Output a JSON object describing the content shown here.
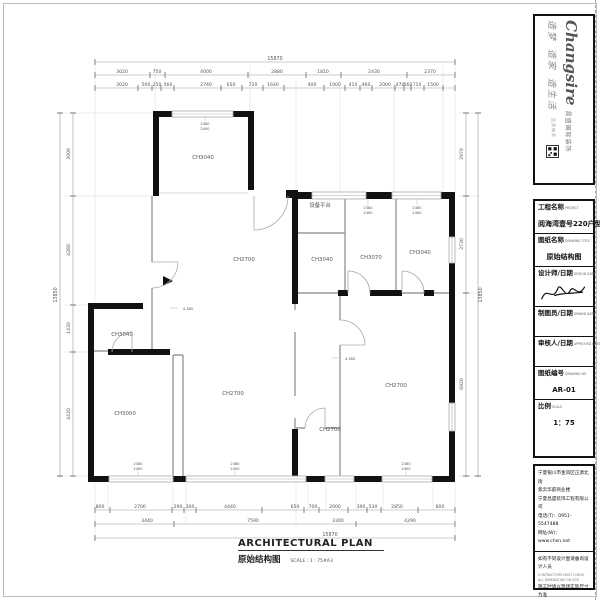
{
  "logo": {
    "brand_en": "Changsire",
    "brand_cn": "昌盛国际装饰",
    "slogan": [
      "造梦",
      "造家",
      "造生活"
    ],
    "tagline": "品质饰家"
  },
  "titleblock": {
    "project_label": "工程名称",
    "project_label_en": "PROJECT",
    "project_value": "阅海湾壹号220户型图",
    "drawing_label": "图纸名称",
    "drawing_label_en": "DRAWING TITLE",
    "drawing_value": "原始结构图",
    "designer_label": "设计师/日期",
    "designer_label_en": "DESIGN DATE",
    "drafter_label": "制图员/日期",
    "drafter_label_en": "DRAWN DATE",
    "auditor_label": "审核人/日期",
    "auditor_label_en": "APPROVED DATE",
    "number_label": "图纸编号",
    "number_label_en": "DRAWING NO",
    "number_value": "AR-01",
    "scale_label": "比例",
    "scale_label_en": "SCALE",
    "scale_value": "1：75"
  },
  "company": {
    "address1": "宁夏银川市金凤区正源北街",
    "address2": "紫云华庭商业楼",
    "name": "宁夏昌盛装饰工程有限公司",
    "phone": "电话(T)：0951-5547488",
    "website": "网址(W)：www.chsn.net",
    "note1": "如有不同设计图请垂询设计人员",
    "note1_en": "CONTRACTORS MUST CHECK ALL DIMENSIONS ON SITE",
    "note2": "施工时请以现场实际尺寸为准",
    "note2_en": "THIS DRAWING IS COPYRIGHT"
  },
  "footer": {
    "title_en": "ARCHITECTURAL PLAN",
    "title_cn": "原始结构图",
    "scale_note": "SCALE : 1 : 75#A3"
  },
  "plan": {
    "overall_top": "15870",
    "overall_bottom": "15870",
    "overall_left": "13850",
    "overall_right": "13850",
    "top_row1": [
      "3020",
      "750",
      "4000",
      "2880",
      "1810",
      "2430",
      "2370"
    ],
    "top_row2": [
      "3020",
      "500",
      "250",
      "560",
      "2740",
      "650",
      "720",
      "1640",
      "400",
      "1000",
      "410",
      "460",
      "2000",
      "470",
      "560",
      "710",
      "1500"
    ],
    "left_col": [
      "3000",
      "4280",
      "1430",
      "4420"
    ],
    "right_col": [
      "2970",
      "3730",
      "6920"
    ],
    "bottom_row1": [
      "800",
      "2700",
      "290",
      "300",
      "4440",
      "650",
      "700",
      "2000",
      "390",
      "530",
      "2850",
      "800"
    ],
    "bottom_row2": [
      "3440",
      "7590",
      "3300",
      "4290"
    ],
    "rooms": [
      "CH3040",
      "CH2700",
      "CH3040",
      "CH3000",
      "CH2700",
      "设备平台",
      "CH3040",
      "CH3070",
      "CH3040",
      "CH2700",
      "CH2700"
    ],
    "window_note_1": "2380",
    "window_note_2": "2400",
    "level_note": "4.380"
  }
}
